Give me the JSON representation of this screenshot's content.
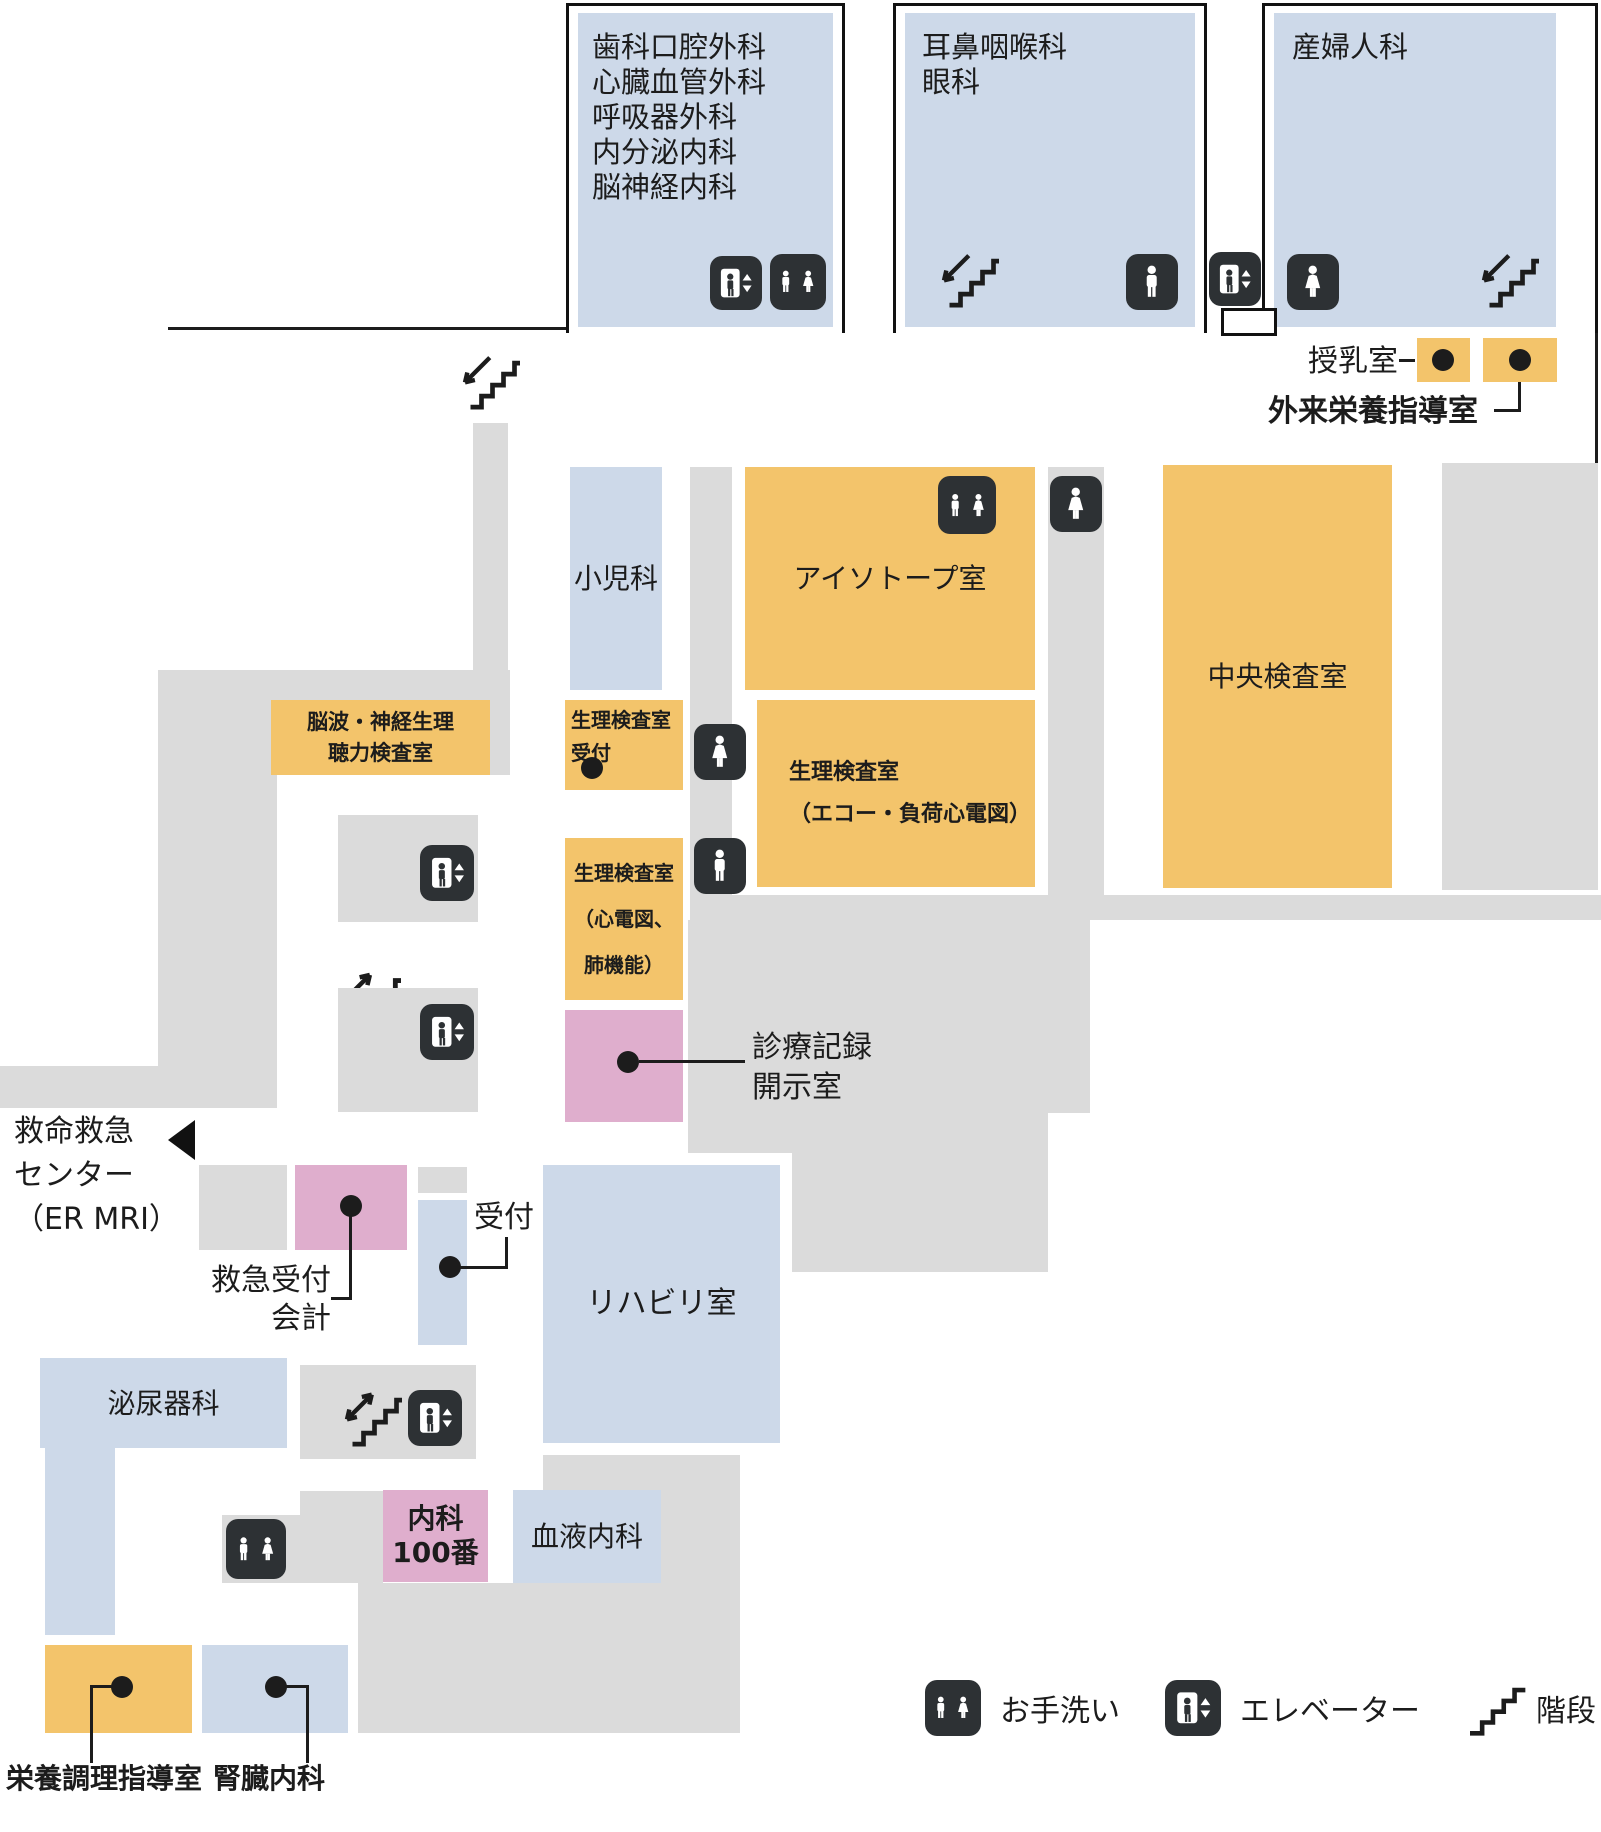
{
  "colors": {
    "room_blue": "#cdd9e9",
    "room_orange": "#f3c46b",
    "room_pink": "#dfaecd",
    "corridor_gray": "#dbdbdb",
    "icon_dark": "#2d3134",
    "text": "#1c1c1c"
  },
  "rooms": {
    "dept_group": {
      "lines": [
        "歯科口腔外科",
        "心臓血管外科",
        "呼吸器外科",
        "内分泌内科",
        "脳神経内科"
      ]
    },
    "ent_eye": {
      "lines": [
        "耳鼻咽喉科",
        "眼科"
      ]
    },
    "obgyn": "産婦人科",
    "pediatrics": "小児科",
    "isotope": "アイソトープ室",
    "central_lab": "中央検査室",
    "eeg": {
      "lines": [
        "脳波・神経生理",
        "聴力検査室"
      ]
    },
    "physio_reception": {
      "lines": [
        "生理検査室",
        "受付"
      ]
    },
    "physio_echo": {
      "lines": [
        "生理検査室",
        "（エコー・負荷心電図）"
      ]
    },
    "physio_ecg": {
      "lines": [
        "生理検査室",
        "（心電図、",
        "肺機能）"
      ]
    },
    "rehab": "リハビリ室",
    "urology": "泌尿器科",
    "naika100": {
      "lines": [
        "内科",
        "100番"
      ]
    },
    "hematology": "血液内科"
  },
  "labels": {
    "nursing_room": "授乳室",
    "outpatient_nutrition": "外来栄養指導室",
    "records": {
      "lines": [
        "診療記録",
        "開示室"
      ]
    },
    "er": {
      "lines": [
        "救命救急",
        "センター",
        "（ER MRI）"
      ]
    },
    "er_reception": {
      "lines": [
        "救急受付",
        "会計"
      ]
    },
    "reception": "受付",
    "nutrition_cooking": "栄養調理指導室",
    "nephrology": "腎臓内科"
  },
  "legend": {
    "toilet": "お手洗い",
    "elevator": "エレベーター",
    "stairs": "階段"
  },
  "icons": {
    "toilet": "toilet-icon",
    "elevator": "elevator-icon",
    "stairs": "stairs-icon"
  }
}
